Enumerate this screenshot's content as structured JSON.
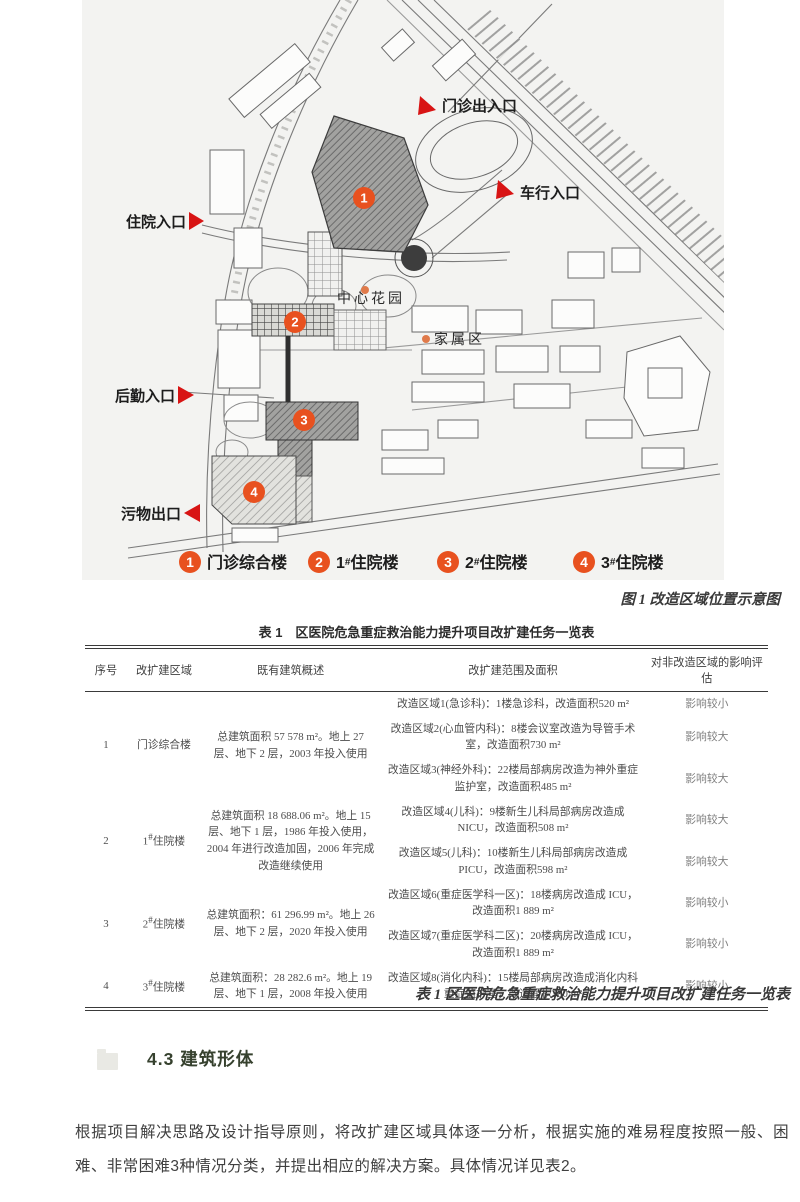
{
  "map": {
    "entrances": [
      {
        "label": "门诊出入口"
      },
      {
        "label": "车行入口"
      },
      {
        "label": "住院入口"
      },
      {
        "label": "后勤入口"
      },
      {
        "label": "污物出口"
      }
    ],
    "areas": {
      "center_garden": "中心花园",
      "family_area": "家属区"
    },
    "markers": [
      "1",
      "2",
      "3",
      "4"
    ],
    "legend": [
      {
        "num": "1",
        "pre": "",
        "sup": "",
        "name": "门诊综合楼"
      },
      {
        "num": "2",
        "pre": "1",
        "sup": "#",
        "name": "住院楼"
      },
      {
        "num": "3",
        "pre": "2",
        "sup": "#",
        "name": "住院楼"
      },
      {
        "num": "4",
        "pre": "3",
        "sup": "#",
        "name": "住院楼"
      }
    ],
    "colors": {
      "marker": "#e8511f",
      "arrow": "#d81414"
    }
  },
  "figure_caption": "图 1  改造区域位置示意图",
  "table": {
    "title": "表 1　区医院危急重症救治能力提升项目改扩建任务一览表",
    "caption": "表 1  区医院危急重症救治能力提升项目改扩建任务一览表",
    "headers": [
      "序号",
      "改扩建区域",
      "既有建筑概述",
      "改扩建范围及面积",
      "对非改造区域的影响评估"
    ],
    "rows": [
      {
        "no": "1",
        "area": "门诊综合楼",
        "desc": "总建筑面积 57 578 m²。地上 27 层、地下 2 层，2003 年投入使用",
        "items": [
          {
            "scope": "改造区域1(急诊科)：1楼急诊科，改造面积520 m²",
            "impact": "影响较小"
          },
          {
            "scope": "改造区域2(心血管内科)：8楼会议室改造为导管手术室，改造面积730 m²",
            "impact": "影响较大"
          },
          {
            "scope": "改造区域3(神经外科)：22楼局部病房改造为神外重症监护室，改造面积485 m²",
            "impact": "影响较大"
          }
        ]
      },
      {
        "no": "2",
        "area": "1#住院楼",
        "desc": "总建筑面积 18 688.06 m²。地上 15 层、地下 1 层，1986 年投入使用，2004 年进行改造加固，2006 年完成改造继续使用",
        "items": [
          {
            "scope": "改造区域4(儿科)：9楼新生儿科局部病房改造成 NICU，改造面积508 m²",
            "impact": "影响较大"
          },
          {
            "scope": "改造区域5(儿科)：10楼新生儿科局部病房改造成 PICU，改造面积598 m²",
            "impact": "影响较大"
          }
        ]
      },
      {
        "no": "3",
        "area": "2#住院楼",
        "desc": "总建筑面积：61 296.99 m²。地上 26 层、地下 2 层，2020 年投入使用",
        "items": [
          {
            "scope": "改造区域6(重症医学科一区)：18楼病房改造成 ICU，改造面积1 889 m²",
            "impact": "影响较小"
          },
          {
            "scope": "改造区域7(重症医学科二区)：20楼病房改造成 ICU，改造面积1 889 m²",
            "impact": "影响较小"
          }
        ]
      },
      {
        "no": "4",
        "area": "3#住院楼",
        "desc": "总建筑面积：28 282.6 m²。地上 19 层、地下 1 层，2008 年投入使用",
        "items": [
          {
            "scope": "改造区域8(消化内科)：15楼局部病房改造成消化内科重症监护室，改造面积300 m²",
            "impact": "影响较小"
          }
        ]
      }
    ]
  },
  "section": {
    "heading": "4.3 建筑形体"
  },
  "paragraph": "根据项目解决思路及设计指导原则，将改扩建区域具体逐一分析，根据实施的难易程度按照一般、困难、非常困难3种情况分类，并提出相应的解决方案。具体情况详见表2。"
}
